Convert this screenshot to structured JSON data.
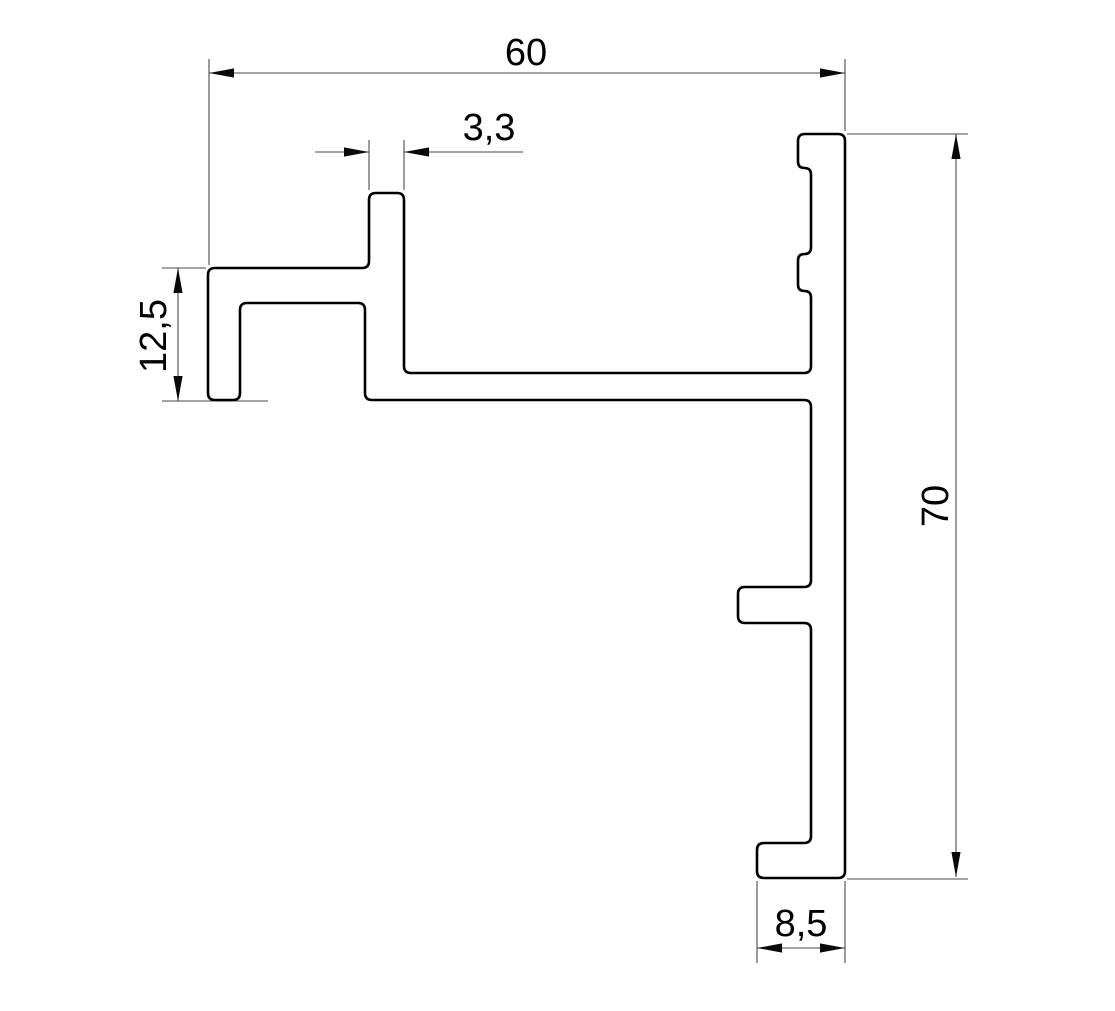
{
  "canvas": {
    "width": 1115,
    "height": 1011,
    "background": "#ffffff"
  },
  "profile": {
    "name": "aluminium-profile-cross-section",
    "corner_radius": 7,
    "stroke_color": "#000000",
    "stroke_width": 2.6,
    "outline_points": [
      [
        208,
        268
      ],
      [
        369,
        268
      ],
      [
        369,
        193
      ],
      [
        404,
        193
      ],
      [
        404,
        373
      ],
      [
        811,
        373
      ],
      [
        811,
        291
      ],
      [
        798,
        291
      ],
      [
        798,
        254
      ],
      [
        811,
        254
      ],
      [
        811,
        168
      ],
      [
        798,
        168
      ],
      [
        798,
        134
      ],
      [
        845,
        134
      ],
      [
        845,
        878
      ],
      [
        757,
        878
      ],
      [
        757,
        843
      ],
      [
        811,
        843
      ],
      [
        811,
        623
      ],
      [
        738,
        623
      ],
      [
        738,
        587
      ],
      [
        811,
        587
      ],
      [
        811,
        400
      ],
      [
        365,
        400
      ],
      [
        365,
        303
      ],
      [
        240,
        303
      ],
      [
        240,
        400
      ],
      [
        208,
        400
      ]
    ]
  },
  "annotations": {
    "line_color": "#4a4a4a",
    "line_width": 1.1,
    "arrow_color": "#0a0a0a",
    "arrow_length": 25,
    "arrow_half_width": 4.6
  },
  "dimensions": [
    {
      "label": "60",
      "value": "60",
      "orientation": "horizontal",
      "label_transform": "translate(526,65)",
      "dim_lines": [
        [
          209,
          73,
          845,
          73
        ]
      ],
      "ext_lines": [
        [
          209,
          59,
          209,
          265
        ],
        [
          845,
          59,
          845,
          131
        ]
      ],
      "arrows": [
        [
          209,
          73,
          180
        ],
        [
          845,
          73,
          0
        ]
      ]
    },
    {
      "label": "3,3",
      "value": "3.3",
      "orientation": "horizontal",
      "label_transform": "translate(489,140)",
      "dim_lines": [
        [
          315,
          152,
          369,
          152
        ],
        [
          404,
          152,
          523,
          152
        ]
      ],
      "ext_lines": [
        [
          369,
          140,
          369,
          190
        ],
        [
          404,
          140,
          404,
          190
        ]
      ],
      "arrows": [
        [
          369,
          152,
          0
        ],
        [
          404,
          152,
          180
        ]
      ]
    },
    {
      "label": "12,5",
      "value": "12.5",
      "orientation": "vertical",
      "label_transform": "translate(166,336) rotate(-90)",
      "dim_lines": [
        [
          178,
          268,
          178,
          401
        ]
      ],
      "ext_lines": [
        [
          162,
          268,
          206,
          268
        ],
        [
          162,
          401,
          268,
          401
        ]
      ],
      "arrows": [
        [
          178,
          268,
          270
        ],
        [
          178,
          401,
          90
        ]
      ]
    },
    {
      "label": "70",
      "value": "70",
      "orientation": "vertical",
      "label_transform": "translate(948,506) rotate(-90)",
      "dim_lines": [
        [
          956,
          134,
          956,
          877
        ]
      ],
      "ext_lines": [
        [
          847,
          134,
          968,
          134
        ],
        [
          847,
          879,
          968,
          879
        ]
      ],
      "arrows": [
        [
          956,
          134,
          270
        ],
        [
          956,
          877,
          90
        ]
      ]
    },
    {
      "label": "8,5",
      "value": "8.5",
      "orientation": "horizontal",
      "label_transform": "translate(801,936)",
      "dim_lines": [
        [
          757,
          948,
          845,
          948
        ]
      ],
      "ext_lines": [
        [
          757,
          881,
          757,
          963
        ],
        [
          845,
          881,
          845,
          963
        ]
      ],
      "arrows": [
        [
          757,
          948,
          180
        ],
        [
          845,
          948,
          0
        ]
      ]
    }
  ]
}
